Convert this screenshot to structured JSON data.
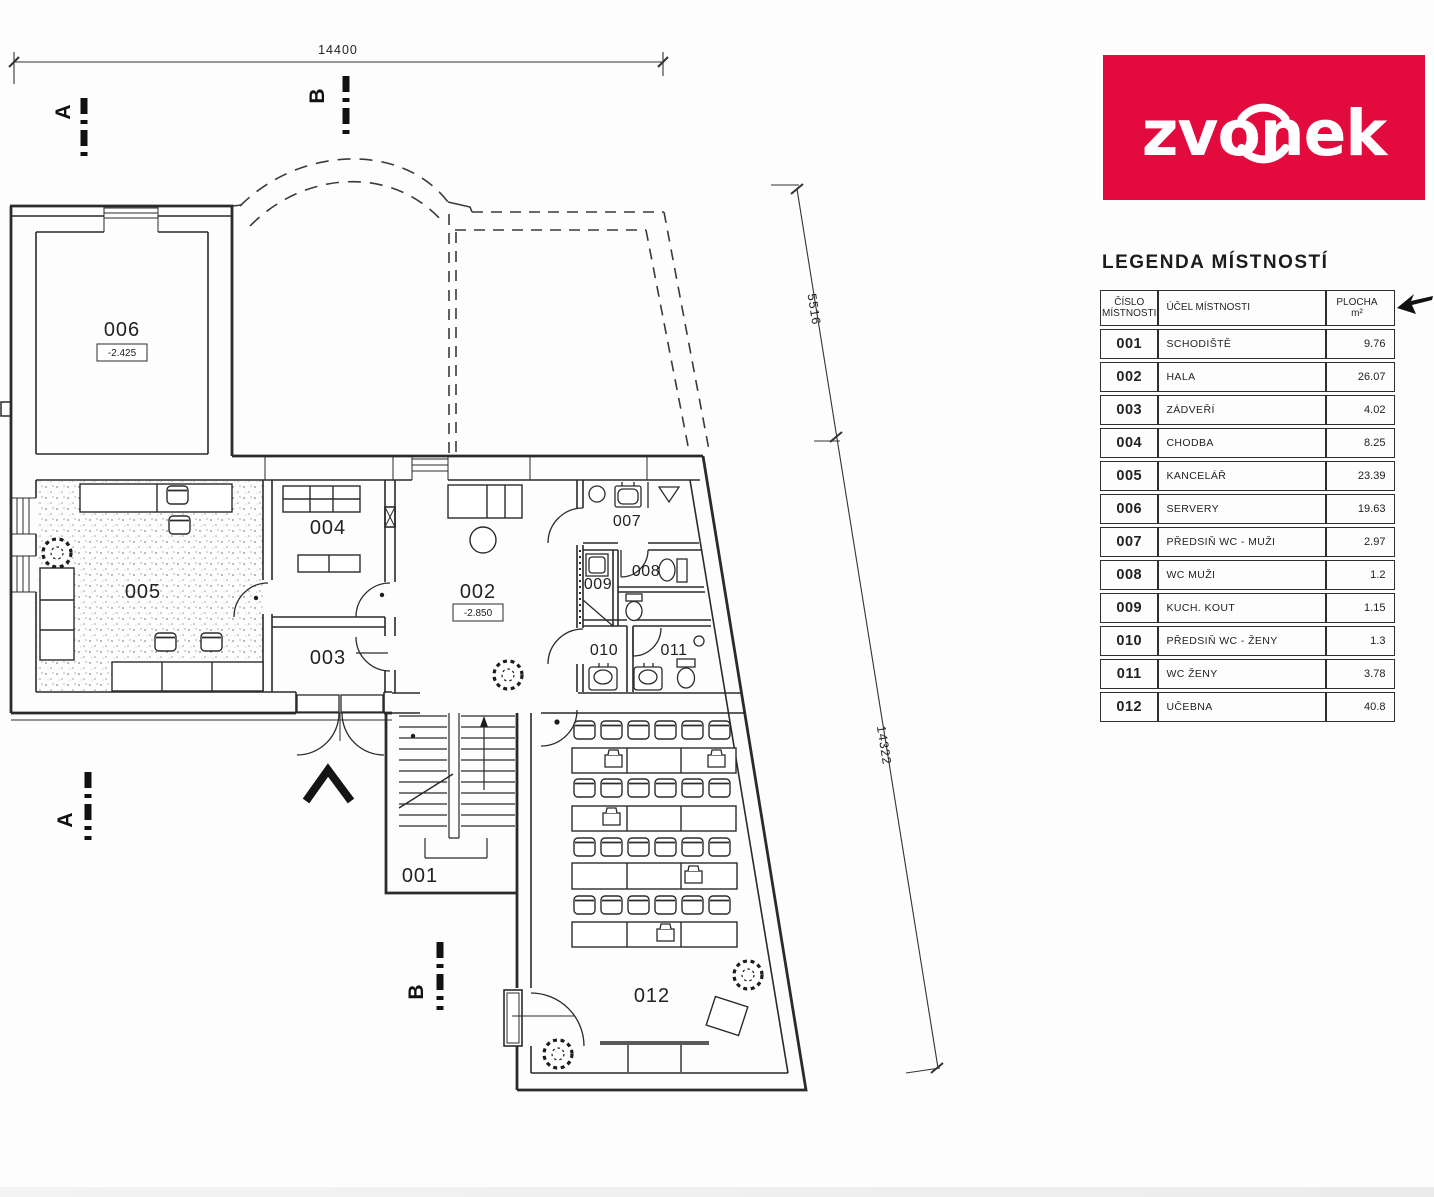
{
  "logo": {
    "text": "zvonek",
    "bg_color": "#e30b3d",
    "bg_style": "background:#e30b3d",
    "text_color": "#ffffff"
  },
  "legend": {
    "title": "LEGENDA MÍSTNOSTÍ",
    "header": {
      "number_line1": "ČÍSLO",
      "number_line2": "MÍSTNOSTI",
      "purpose": "ÚČEL MÍSTNOSTI",
      "area_line1": "PLOCHA",
      "area_line2": "m²"
    },
    "rows": [
      {
        "number": "001",
        "purpose": "SCHODIŠTĚ",
        "area": "9.76"
      },
      {
        "number": "002",
        "purpose": "HALA",
        "area": "26.07"
      },
      {
        "number": "003",
        "purpose": "ZÁDVEŘÍ",
        "area": "4.02"
      },
      {
        "number": "004",
        "purpose": "CHODBA",
        "area": "8.25"
      },
      {
        "number": "005",
        "purpose": "KANCELÁŘ",
        "area": "23.39"
      },
      {
        "number": "006",
        "purpose": "SERVERY",
        "area": "19.63"
      },
      {
        "number": "007",
        "purpose": "PŘEDSIŇ WC - MUŽI",
        "area": "2.97"
      },
      {
        "number": "008",
        "purpose": "WC MUŽI",
        "area": "1.2"
      },
      {
        "number": "009",
        "purpose": "KUCH. KOUT",
        "area": "1.15"
      },
      {
        "number": "010",
        "purpose": "PŘEDSIŇ WC - ŽENY",
        "area": "1.3"
      },
      {
        "number": "011",
        "purpose": "WC ŽENY",
        "area": "3.78"
      },
      {
        "number": "012",
        "purpose": "UČEBNA",
        "area": "40.8"
      }
    ]
  },
  "plan": {
    "dimensions": {
      "top_width": "14400",
      "right_upper": "5516",
      "right_lower": "14322"
    },
    "section_markers": {
      "a": "A",
      "b": "B"
    },
    "rooms": {
      "r001": "001",
      "r002": "002",
      "r003": "003",
      "r004": "004",
      "r005": "005",
      "r006": "006",
      "r007": "007",
      "r008": "008",
      "r009": "009",
      "r010": "010",
      "r011": "011",
      "r012": "012"
    },
    "levels": {
      "room006": "-2.425",
      "room002": "-2.850"
    }
  }
}
